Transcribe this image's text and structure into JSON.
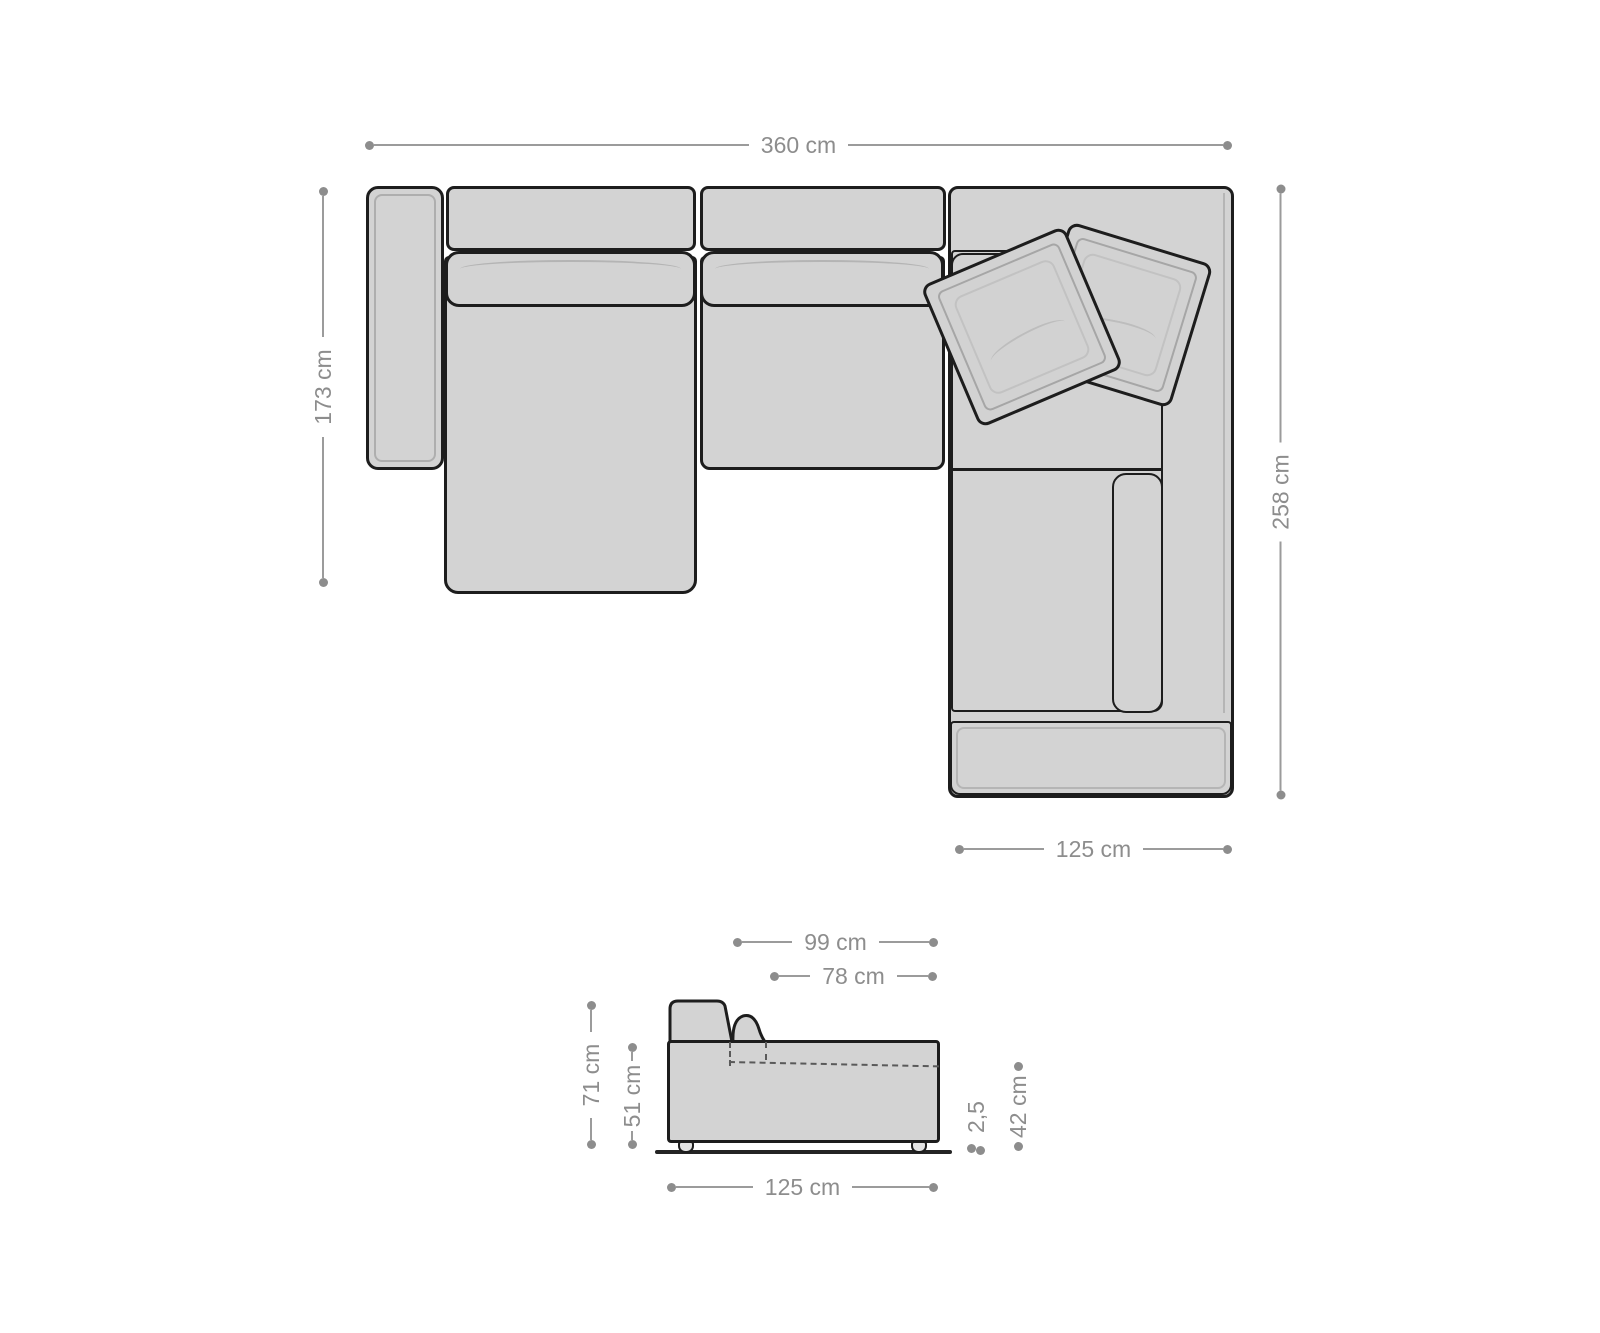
{
  "diagram": {
    "type": "sofa-dimension-diagram",
    "colors": {
      "sofa_fill": "#d3d3d3",
      "outline": "#1d1d1d",
      "inner_line": "#aeaeae",
      "dimension_gray": "#8d8d8d",
      "background": "#ffffff"
    },
    "top_view": {
      "total_width": "360 cm",
      "left_depth": "173 cm",
      "right_depth": "258 cm",
      "corner_width": "125 cm"
    },
    "side_view": {
      "total_depth": "99 cm",
      "seat_depth": "78 cm",
      "back_height": "71 cm",
      "arm_height": "51 cm",
      "element_width": "125 cm",
      "floor_clearance": "2,5",
      "seat_height": "42 cm"
    }
  }
}
